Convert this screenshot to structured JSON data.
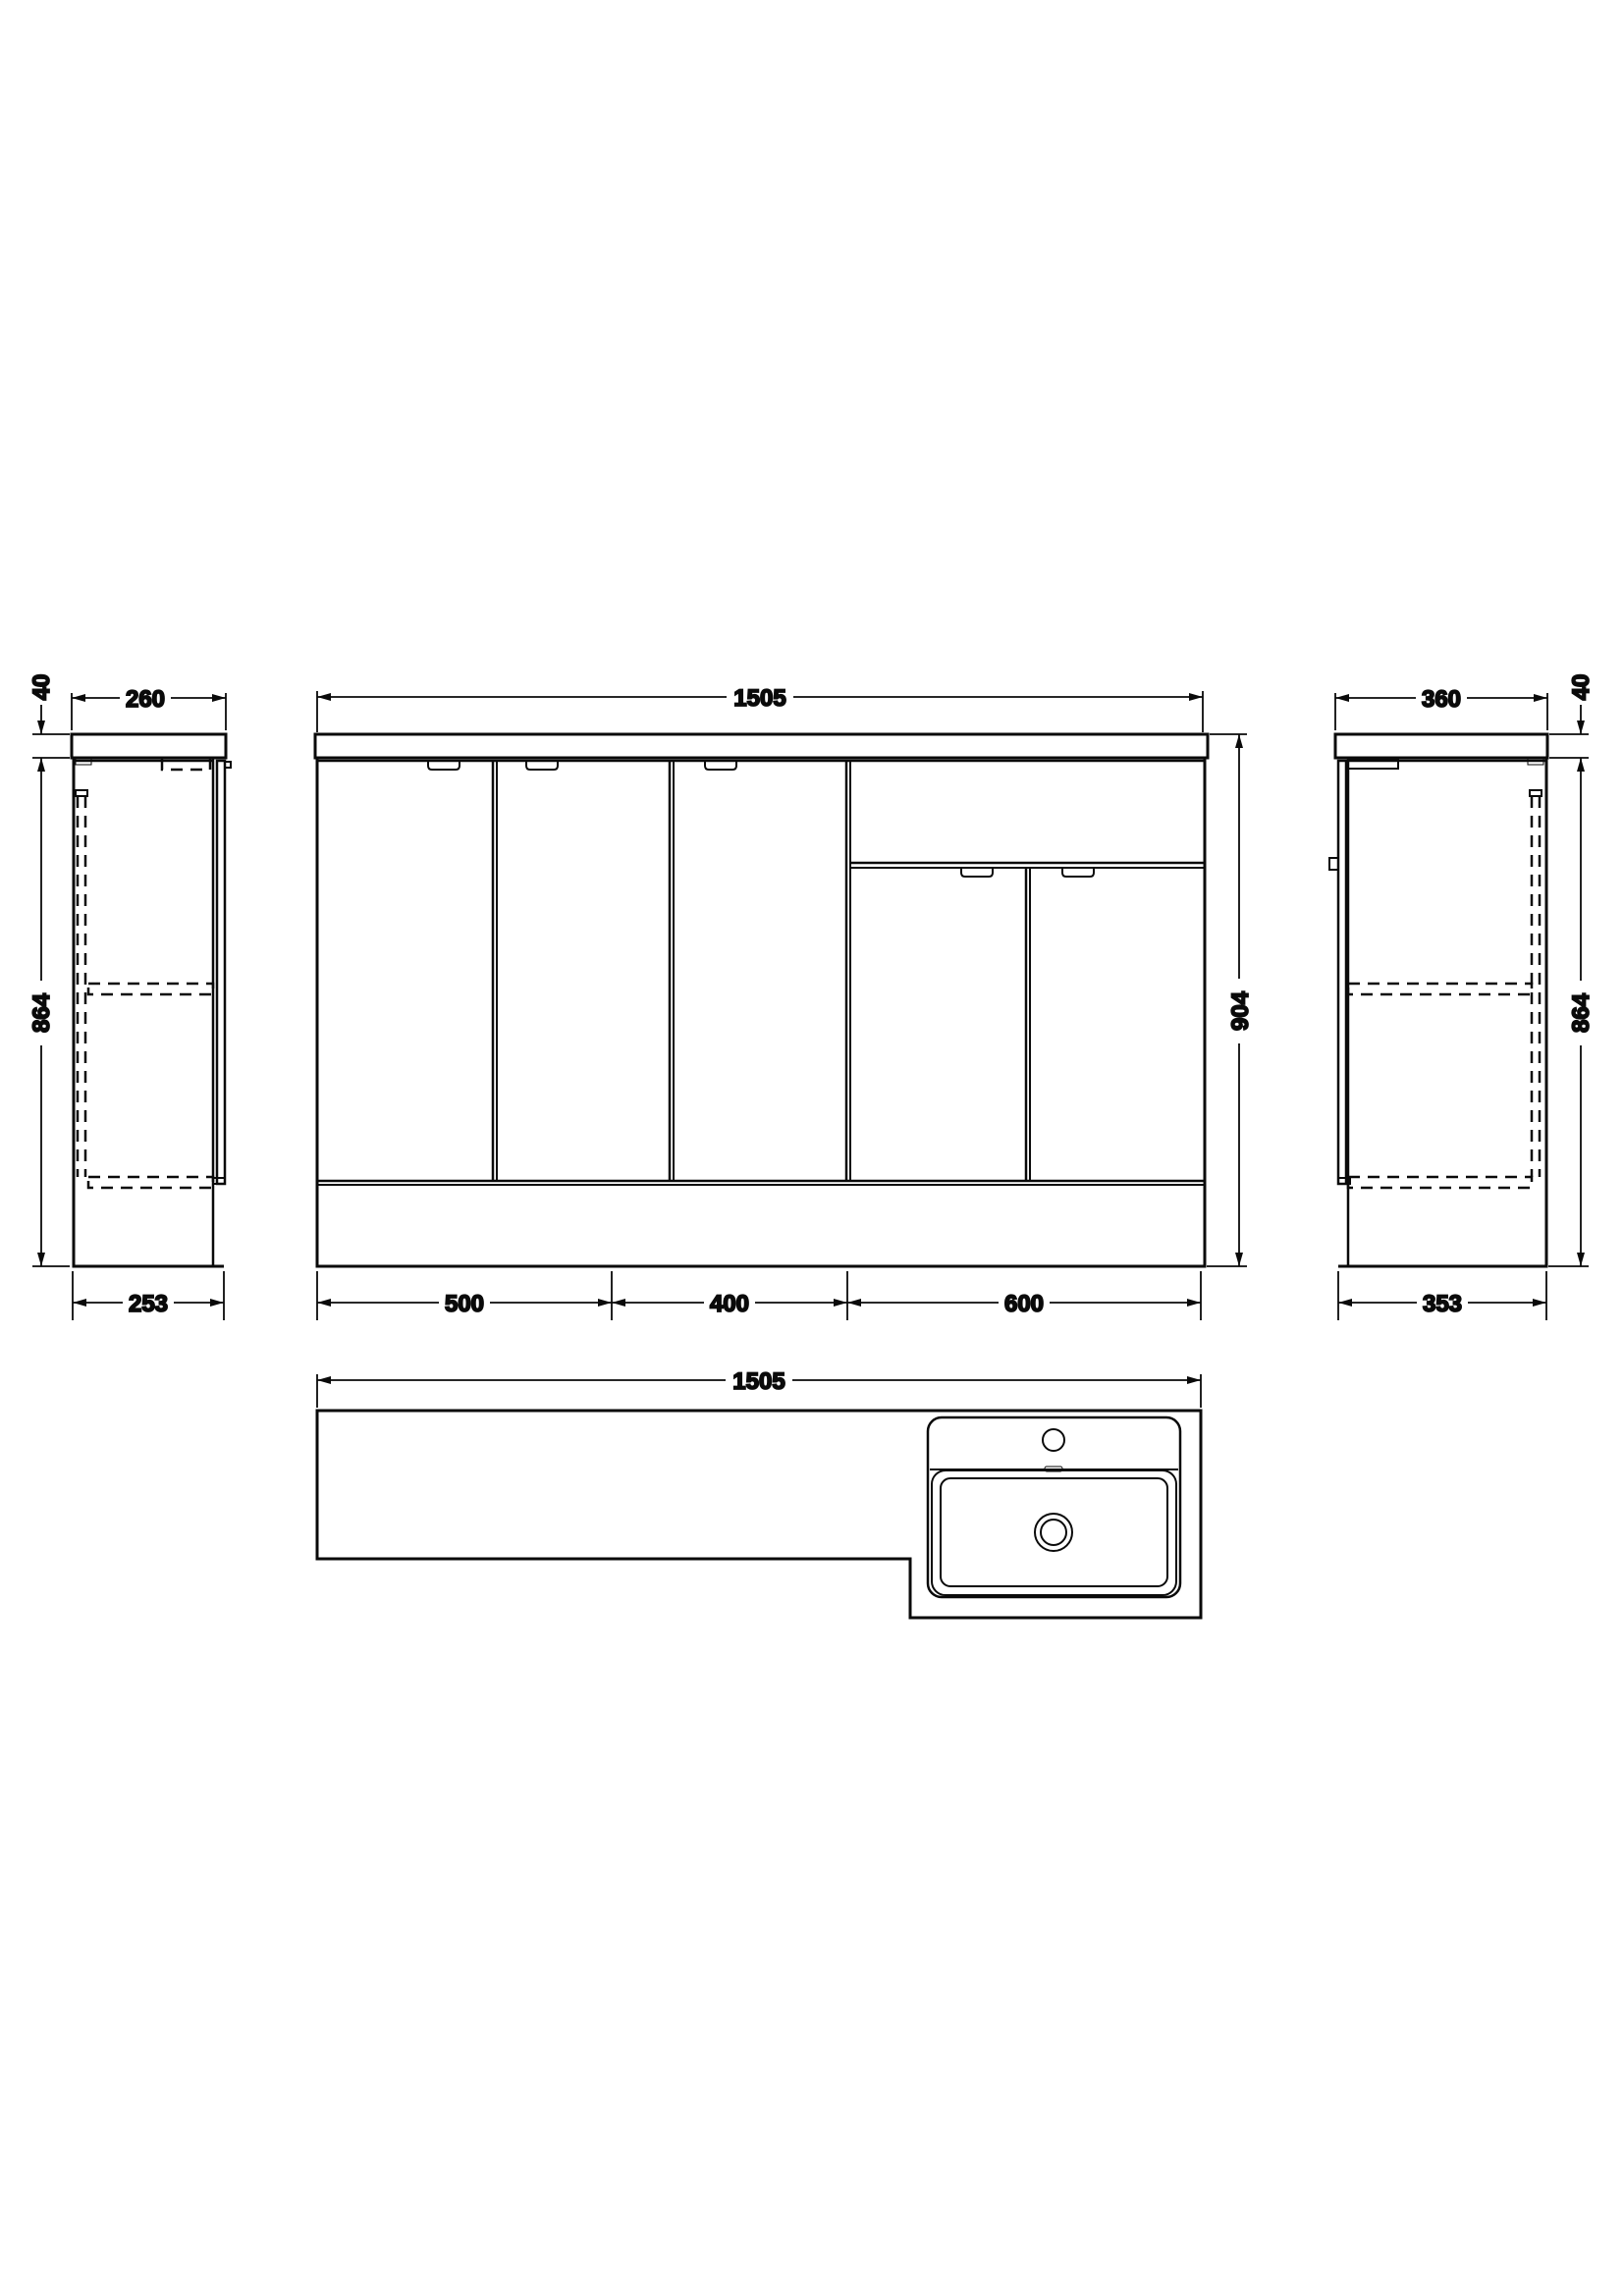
{
  "drawing": {
    "type": "bathroom-vanity-unit-technical-drawing",
    "background_color": "#ffffff",
    "line_color": "#0a0a0a",
    "views": {
      "left_side": {
        "worktop_thickness": "40",
        "top_depth": "260",
        "cabinet_height": "864",
        "base_depth": "253"
      },
      "front": {
        "overall_width": "1505",
        "overall_height": "904",
        "unit_widths": [
          "500",
          "400",
          "600"
        ]
      },
      "right_side": {
        "top_depth": "360",
        "worktop_thickness": "40",
        "cabinet_height": "864",
        "base_depth": "353"
      },
      "plan": {
        "overall_width": "1505"
      }
    }
  }
}
